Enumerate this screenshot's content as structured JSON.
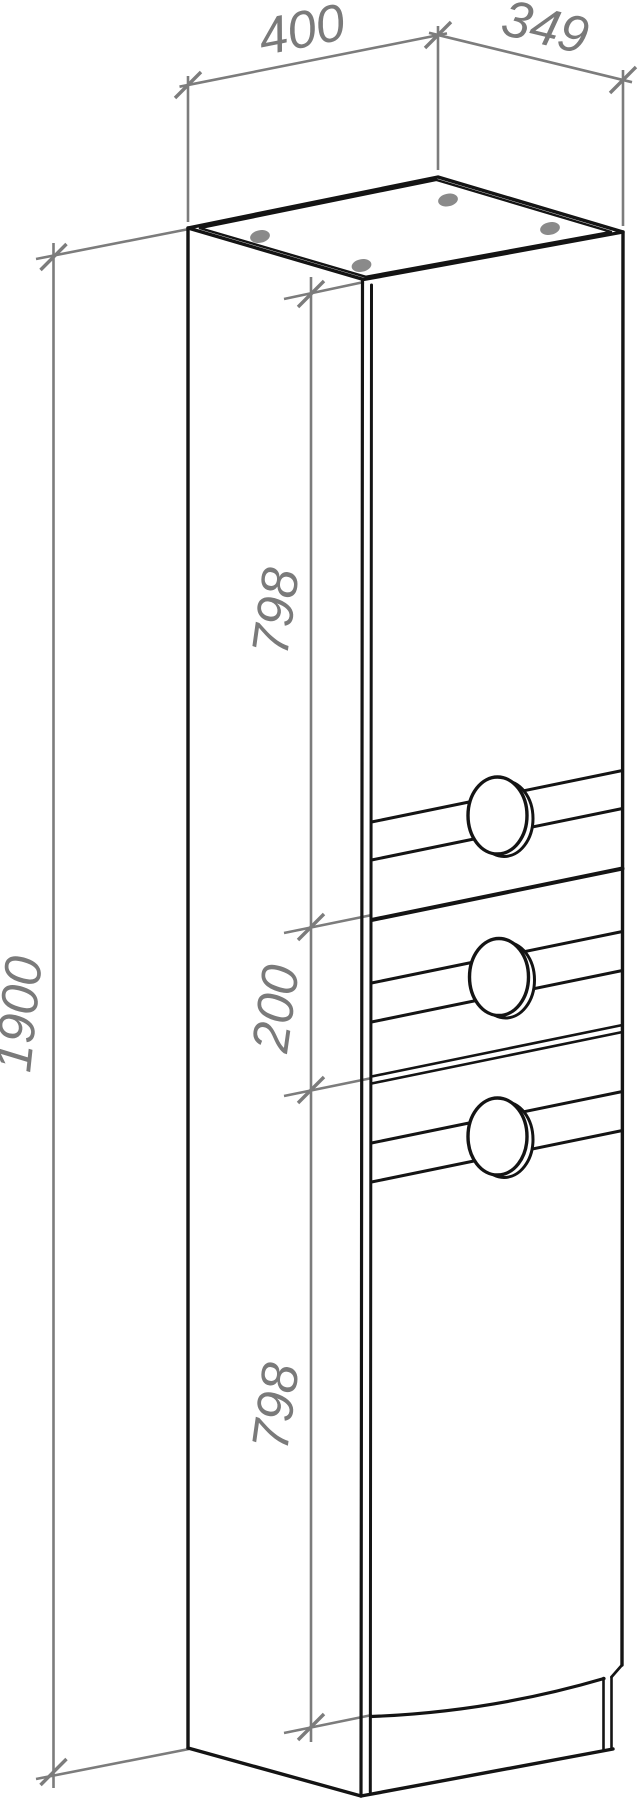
{
  "drawing": {
    "dimensions": {
      "width_top": "400",
      "depth_top": "349",
      "total_height": "1900",
      "upper_door_height": "798",
      "drawer_height": "200",
      "lower_door_height": "798"
    },
    "colors": {
      "outline": "#141414",
      "dimension_gray": "#7c7c7c",
      "text_gray": "#7a7a7a",
      "hole_dot_gray": "#8a8a8a",
      "background": "#ffffff"
    }
  }
}
